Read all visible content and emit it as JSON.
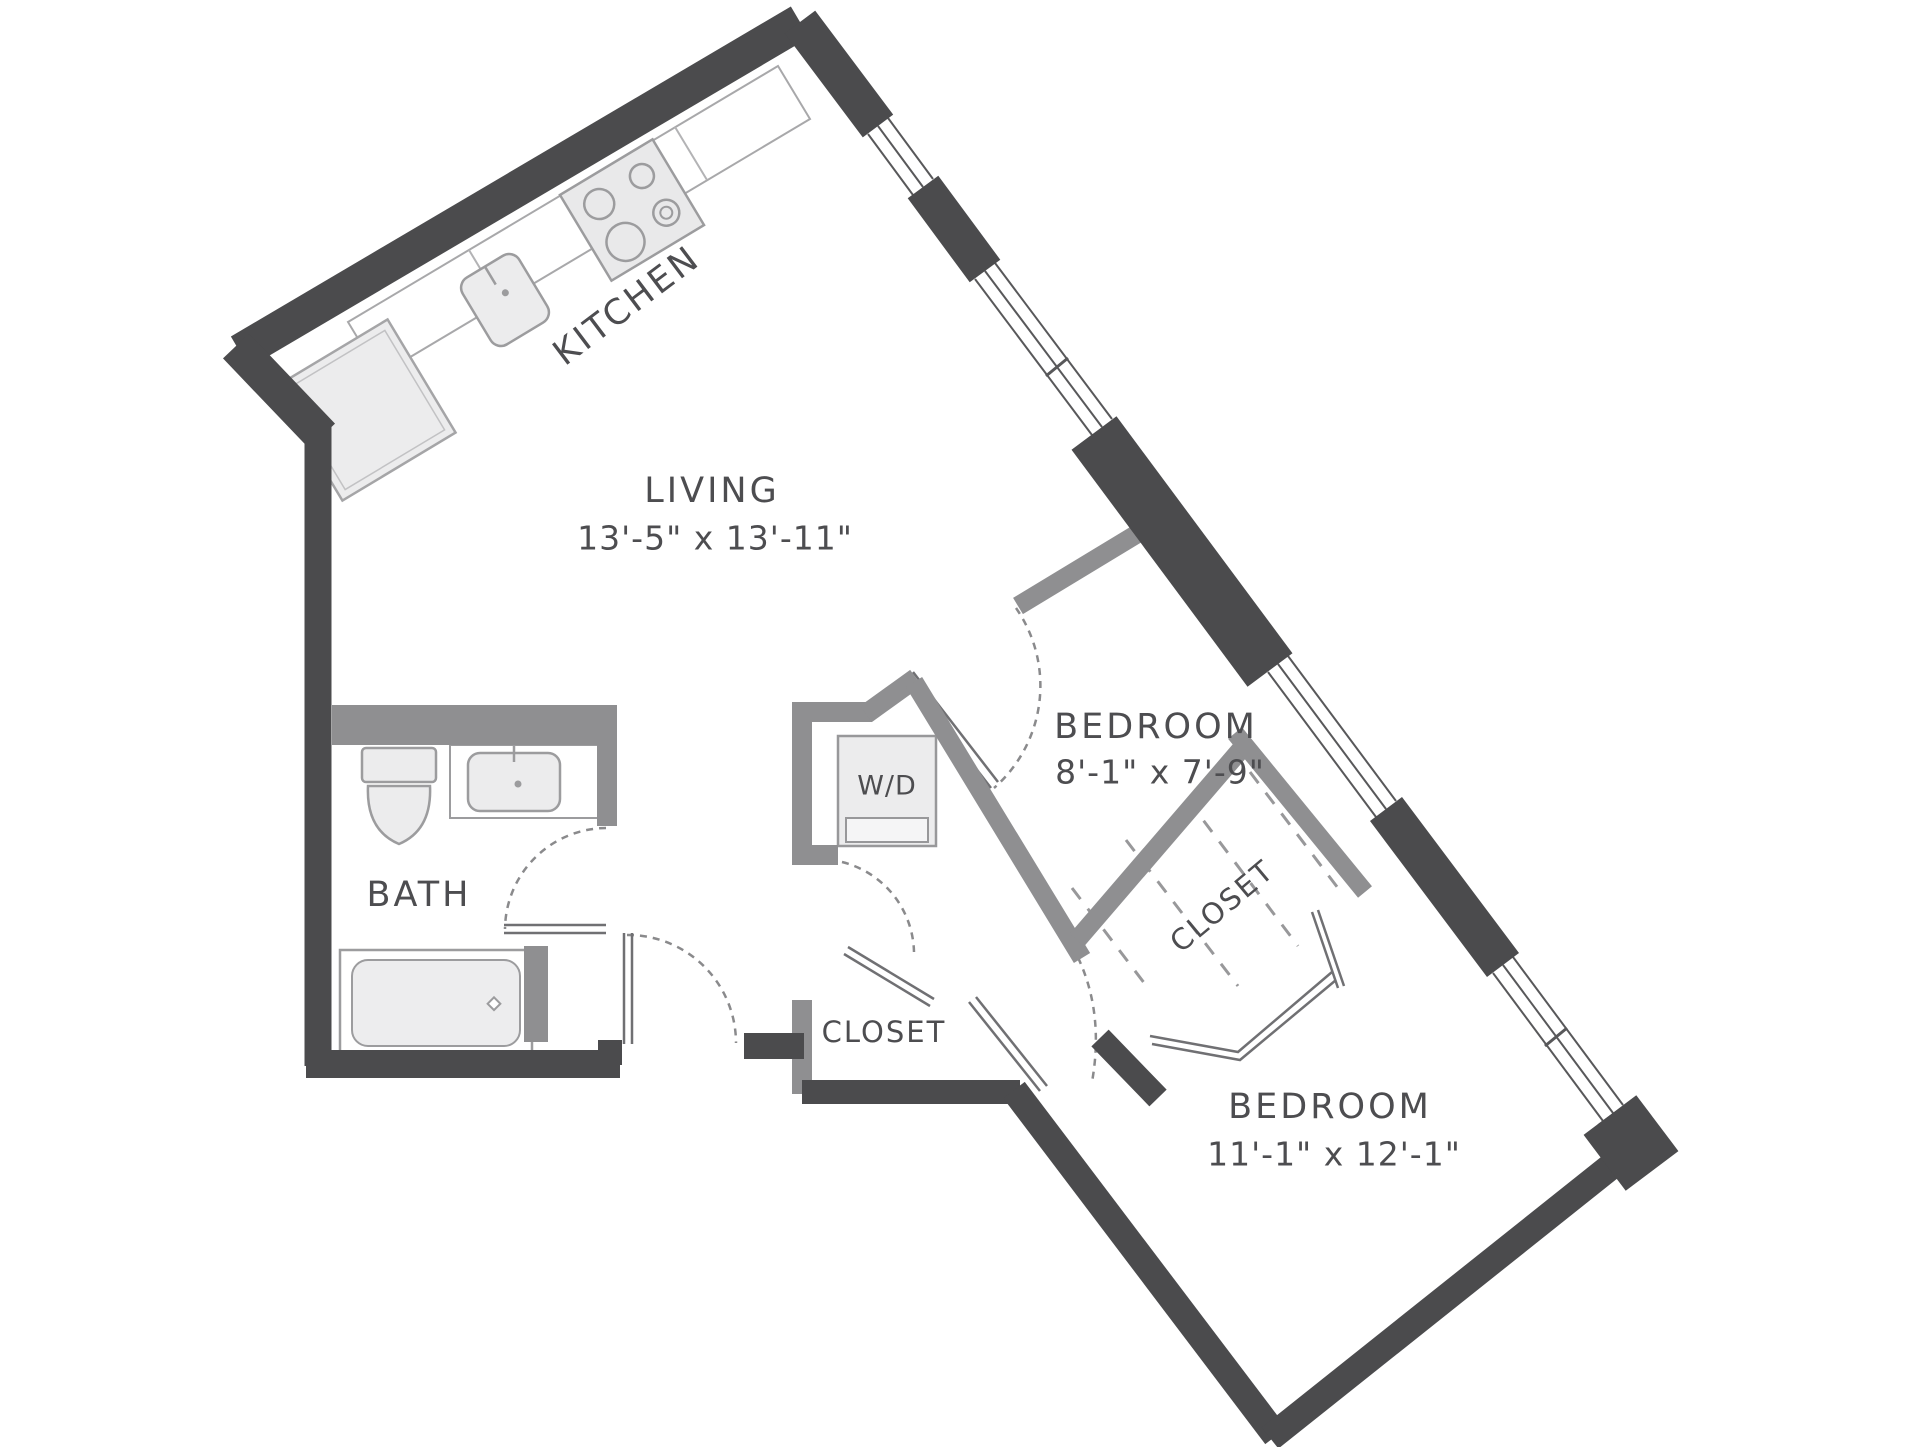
{
  "plan": {
    "title": "Two bedroom apartment floor plan",
    "labels": {
      "kitchen": "KITCHEN",
      "living_name": "LIVING",
      "living_dims": "13'-5\" x 13'-11\"",
      "bedroom1_name": "BEDROOM",
      "bedroom1_dims": "8'-1\" x 7'-9\"",
      "closet1": "CLOSET",
      "bath": "BATH",
      "wd": "W/D",
      "closet2": "CLOSET",
      "bedroom2_name": "BEDROOM",
      "bedroom2_dims": "11'-1\" x 12'-1\""
    },
    "rooms": [
      {
        "name": "KITCHEN",
        "dimensions": ""
      },
      {
        "name": "LIVING",
        "dimensions": "13'-5\" x 13'-11\""
      },
      {
        "name": "BEDROOM",
        "dimensions": "8'-1\" x 7'-9\""
      },
      {
        "name": "BATH",
        "dimensions": ""
      },
      {
        "name": "CLOSET",
        "dimensions": ""
      },
      {
        "name": "CLOSET",
        "dimensions": ""
      },
      {
        "name": "BEDROOM",
        "dimensions": "11'-1\" x 12'-1\""
      }
    ],
    "fixtures": [
      "stove",
      "kitchen-sink",
      "refrigerator",
      "toilet",
      "vanity-sink",
      "bathtub",
      "washer-dryer"
    ],
    "colors": {
      "wall_dark": "#4b4b4d",
      "wall_interior": "#8f8f91",
      "fixture_fill": "#ececed",
      "text": "#4d4d50"
    }
  }
}
